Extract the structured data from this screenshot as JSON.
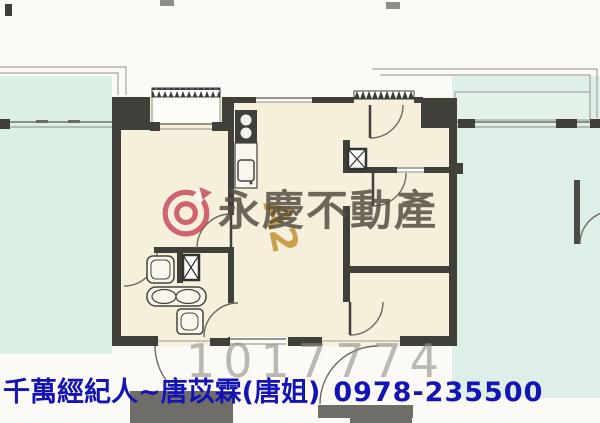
{
  "watermark": {
    "brand": "永慶不動產",
    "logo": "yungching-logo",
    "unit_label": "A2",
    "listing_number": "1017774"
  },
  "footer": {
    "agent_line": "千萬經紀人~唐苡霖(唐姐)",
    "phone": "0978-235500"
  },
  "colors": {
    "background_teal": "#dcefe3",
    "room_cream": "#f6efdc",
    "wall_dark": "#403f3a",
    "brand_gray": "#554d42",
    "logo_red": "#c23e50",
    "unit_label_orange": "#c5973a",
    "listing_gray": "#928f88",
    "footer_blue": "#1414b6",
    "furniture_gray": "#6e6d68"
  }
}
